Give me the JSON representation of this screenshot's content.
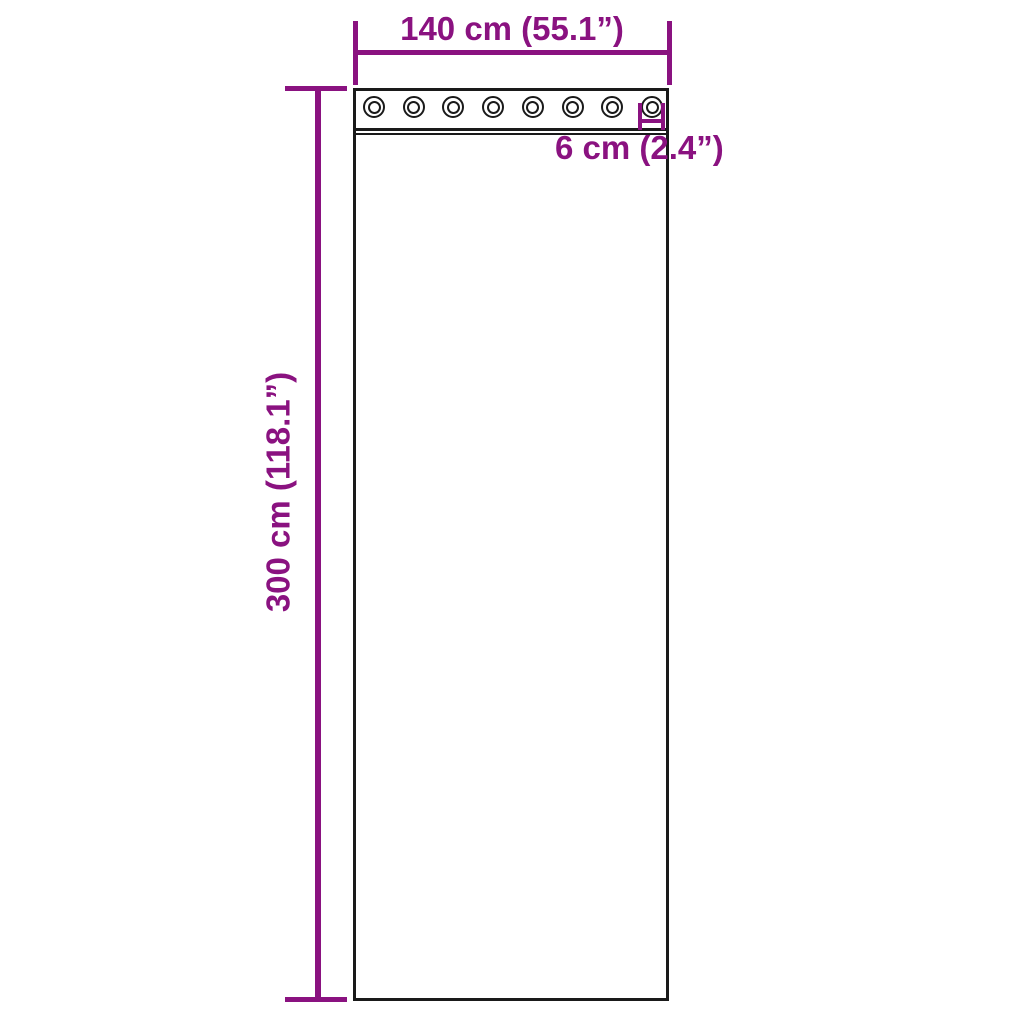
{
  "colors": {
    "annotation": "#8a1280",
    "outline": "#1a1a1a",
    "background": "#ffffff"
  },
  "diagram": {
    "curtain_width_label": "140 cm (55.1”)",
    "curtain_height_label": "300 cm (118.1”)",
    "grommet_size_label": "6 cm (2.4”)",
    "grommet_count": 8
  }
}
